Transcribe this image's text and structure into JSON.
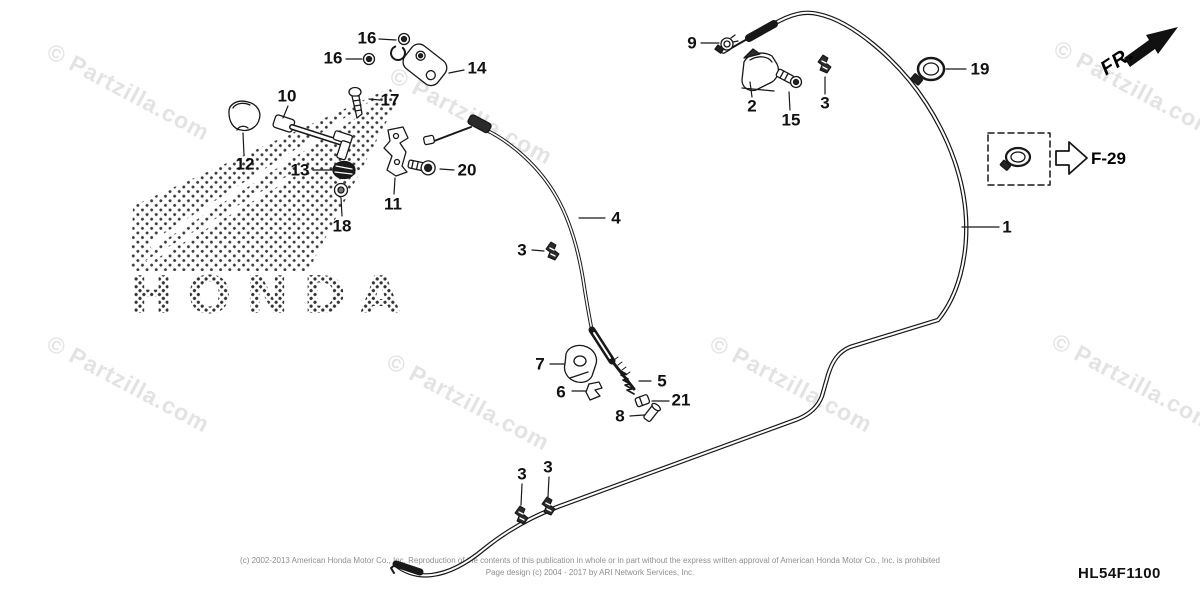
{
  "watermark": {
    "text": "© Partzilla.com"
  },
  "brand": {
    "honda_text": "HONDA"
  },
  "labels": {
    "fr": "FR.",
    "ref": "F-29",
    "diagram_code": "HL54F1100"
  },
  "callouts": [
    {
      "label": "1"
    },
    {
      "label": "2"
    },
    {
      "label": "3"
    },
    {
      "label": "4"
    },
    {
      "label": "3"
    },
    {
      "label": "5"
    },
    {
      "label": "6"
    },
    {
      "label": "7"
    },
    {
      "label": "8"
    },
    {
      "label": "9"
    },
    {
      "label": "10"
    },
    {
      "label": "11"
    },
    {
      "label": "12"
    },
    {
      "label": "13"
    },
    {
      "label": "14"
    },
    {
      "label": "15"
    },
    {
      "label": "16"
    },
    {
      "label": "16"
    },
    {
      "label": "17"
    },
    {
      "label": "18"
    },
    {
      "label": "19"
    },
    {
      "label": "20"
    },
    {
      "label": "21"
    },
    {
      "label": "3"
    },
    {
      "label": "3"
    }
  ],
  "parts_icons": [
    {
      "callout": "1",
      "name": "control-cable"
    },
    {
      "callout": "2",
      "name": "cable-bracket"
    },
    {
      "callout": "3",
      "name": "cable-clip"
    },
    {
      "callout": "4",
      "name": "inner-cable"
    },
    {
      "callout": "5",
      "name": "spring"
    },
    {
      "callout": "6",
      "name": "clip"
    },
    {
      "callout": "7",
      "name": "boot-grommet"
    },
    {
      "callout": "8",
      "name": "pin"
    },
    {
      "callout": "9",
      "name": "cable-clamp"
    },
    {
      "callout": "10",
      "name": "choke-lever"
    },
    {
      "callout": "11",
      "name": "lever-bracket"
    },
    {
      "callout": "12",
      "name": "knob"
    },
    {
      "callout": "13",
      "name": "grommet"
    },
    {
      "callout": "14",
      "name": "bracket"
    },
    {
      "callout": "15",
      "name": "flange-bolt"
    },
    {
      "callout": "16",
      "name": "flange-bolt"
    },
    {
      "callout": "17",
      "name": "screw"
    },
    {
      "callout": "18",
      "name": "nut"
    },
    {
      "callout": "19",
      "name": "band-clamp"
    },
    {
      "callout": "20",
      "name": "knob-bolt"
    },
    {
      "callout": "21",
      "name": "collar"
    }
  ],
  "footer": {
    "line1": "(c) 2002-2013 American Honda Motor Co., Inc. Reproduction of the contents of this publication in whole or in part without the express written approval of American Honda Motor Co., Inc. is prohibited",
    "line2": "Page design (c) 2004 - 2017 by ARI Network Services, Inc."
  },
  "colors": {
    "line_art": "#181818",
    "watermark": "#e3e3e3",
    "footer_text": "#8f8f8f",
    "background": "#ffffff"
  }
}
